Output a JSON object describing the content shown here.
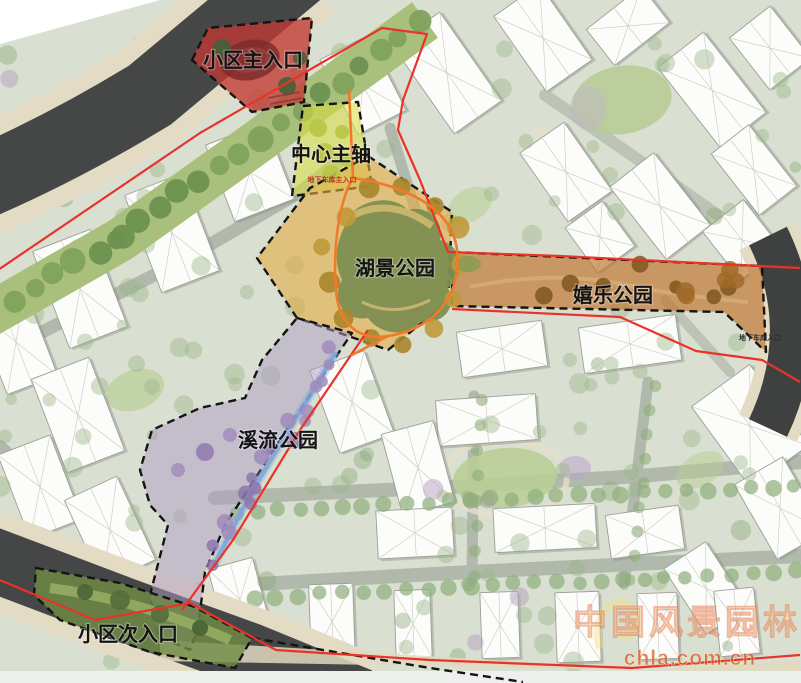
{
  "plan": {
    "zones": {
      "main_entrance": {
        "label": "小区主入口",
        "color": "#c13a33"
      },
      "central_axis": {
        "label": "中心主轴",
        "color": "#d8df3e"
      },
      "lake_park": {
        "label": "湖景公园",
        "color": "#e2ab45"
      },
      "play_park": {
        "label": "嬉乐公园",
        "color": "#bf7430"
      },
      "stream_park": {
        "label": "溪流公园",
        "color": "#b09cc6"
      },
      "secondary_entrance": {
        "label": "小区次入口",
        "color": "#6f8c45"
      }
    },
    "annotations": {
      "garage_main": "地下车库主入口",
      "garage_side": "地下车库入口"
    },
    "colors": {
      "boundary": "#e8332a",
      "route": "#f07a28",
      "water": "#7fa3d8",
      "lake": "#7d8e50"
    }
  },
  "watermark": {
    "site_name": "中国风景园林网",
    "url": "chla.com.cn"
  }
}
